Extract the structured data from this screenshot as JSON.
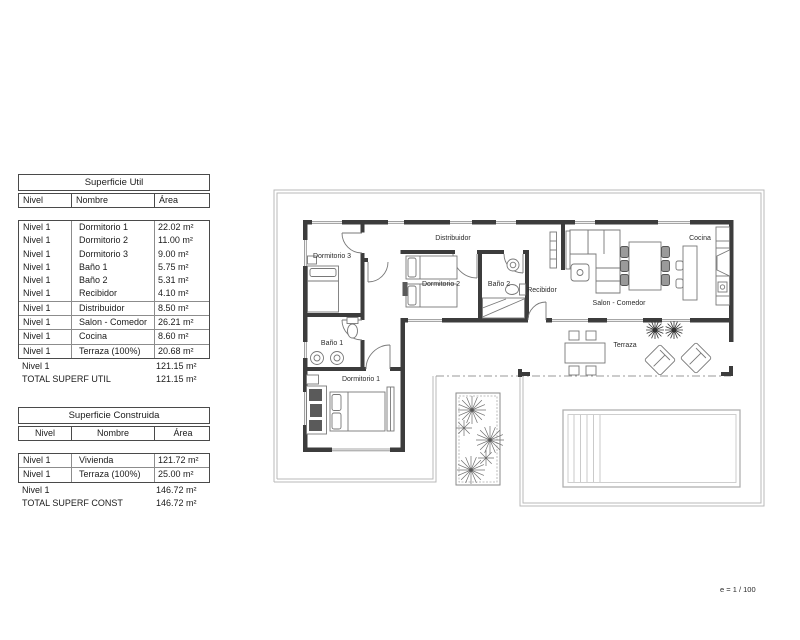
{
  "plan": {
    "scale_label": "e = 1 / 100",
    "room_labels": {
      "dormitorio3": "Dormitorio 3",
      "distribuidor": "Distribuidor",
      "dormitorio2": "Dormitorio 2",
      "bano2": "Baño 2",
      "recibidor": "Recibidor",
      "salon_comedor": "Salon - Comedor",
      "cocina": "Cocina",
      "bano1": "Baño 1",
      "dormitorio1": "Dormitorio 1",
      "terraza": "Terraza"
    }
  },
  "tables": {
    "util": {
      "title": "Superficie Util",
      "headers": {
        "nivel": "Nivel",
        "nombre": "Nombre",
        "area": "Área"
      },
      "rows": [
        {
          "nivel": "Nivel 1",
          "nombre": "Dormitorio 1",
          "area": "22.02 m²"
        },
        {
          "nivel": "Nivel 1",
          "nombre": "Dormitorio 2",
          "area": "11.00 m²"
        },
        {
          "nivel": "Nivel 1",
          "nombre": "Dormitorio 3",
          "area": "9.00 m²"
        },
        {
          "nivel": "Nivel 1",
          "nombre": "Baño 1",
          "area": "5.75 m²"
        },
        {
          "nivel": "Nivel 1",
          "nombre": "Baño 2",
          "area": "5.31 m²"
        },
        {
          "nivel": "Nivel 1",
          "nombre": "Recibidor",
          "area": "4.10 m²"
        },
        {
          "nivel": "Nivel 1",
          "nombre": "Distribuidor",
          "area": "8.50 m²"
        },
        {
          "nivel": "Nivel 1",
          "nombre": "Salon - Comedor",
          "area": "26.21 m²"
        },
        {
          "nivel": "Nivel 1",
          "nombre": "Cocina",
          "area": "8.60 m²"
        },
        {
          "nivel": "Nivel 1",
          "nombre": "Terraza (100%)",
          "area": "20.68 m²"
        }
      ],
      "subtotal": {
        "nivel": "Nivel 1",
        "area": "121.15 m²"
      },
      "total": {
        "label": "TOTAL SUPERF UTIL",
        "area": "121.15 m²"
      }
    },
    "construida": {
      "title": "Superficie Construida",
      "headers": {
        "nivel": "Nivel",
        "nombre": "Nombre",
        "area": "Área"
      },
      "rows": [
        {
          "nivel": "Nivel 1",
          "nombre": "Vivienda",
          "area": "121.72 m²"
        },
        {
          "nivel": "Nivel 1",
          "nombre": "Terraza (100%)",
          "area": "25.00 m²"
        }
      ],
      "subtotal": {
        "nivel": "Nivel 1",
        "area": "146.72 m²"
      },
      "total": {
        "label": "TOTAL SUPERF CONST",
        "area": "146.72 m²"
      }
    }
  }
}
